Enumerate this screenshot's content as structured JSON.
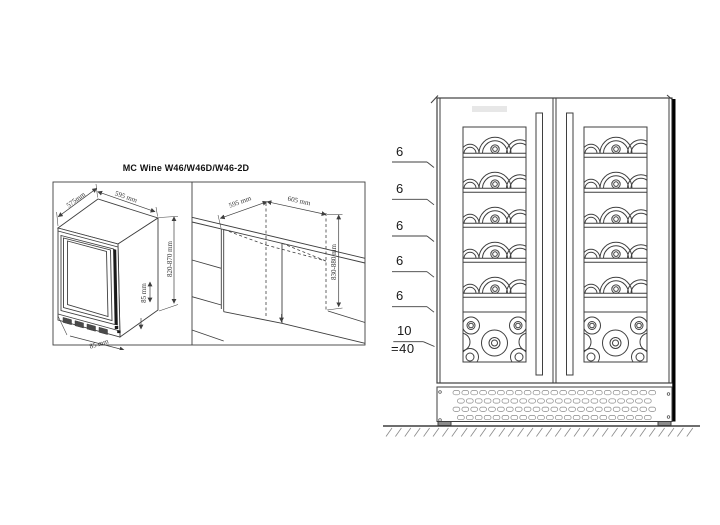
{
  "title": "MC Wine W46/W46D/W46-2D",
  "left_panel": {
    "unit": {
      "width": "575mm",
      "depth": "595 mm",
      "height": "820-870 mm",
      "plinth_height": "85 mm",
      "plinth_depth": "85 mm"
    },
    "niche": {
      "width": "595 mm",
      "depth": "605 mm",
      "height": "830-880 mm"
    }
  },
  "front_view": {
    "shelf_counts": [
      "6",
      "6",
      "6",
      "6",
      "6",
      "10"
    ],
    "total": "=40"
  },
  "colors": {
    "line": "#3f3f3f",
    "light": "#8a8a8a",
    "dark": "#1a1a1a",
    "shadow": "#000000",
    "panel_fill": "#ffffff",
    "display_fill": "#e7e7e7",
    "slot_fill": "#4a4a4a",
    "foot_fill": "#8c8c8c"
  }
}
